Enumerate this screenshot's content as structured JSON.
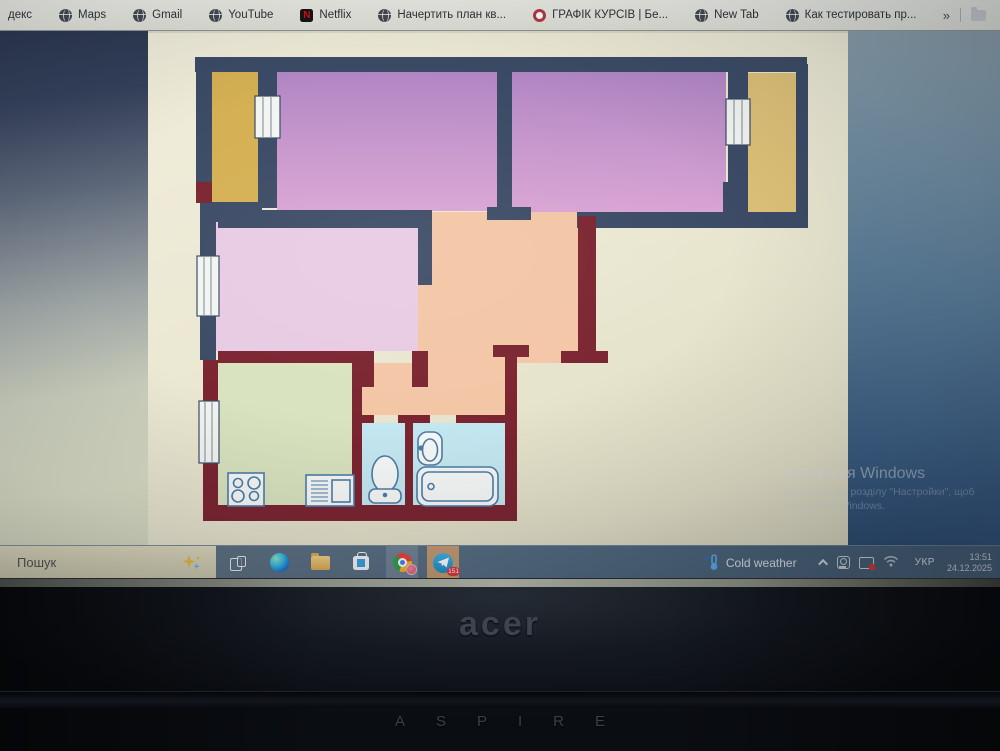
{
  "bookmarks_bar": {
    "items": [
      {
        "label": "декс",
        "icon": "none"
      },
      {
        "label": "Maps",
        "icon": "globe"
      },
      {
        "label": "Gmail",
        "icon": "globe"
      },
      {
        "label": "YouTube",
        "icon": "globe"
      },
      {
        "label": "Netflix",
        "icon": "netflix"
      },
      {
        "label": "Начертить план кв...",
        "icon": "globe"
      },
      {
        "label": "ГРАФІК КУРСІВ | Бе...",
        "icon": "target"
      },
      {
        "label": "New Tab",
        "icon": "globe"
      },
      {
        "label": "Как тестировать пр...",
        "icon": "globe"
      },
      {
        "label": "Mystat",
        "icon": "globe"
      }
    ],
    "overflow": "»"
  },
  "floorplan": {
    "description": "apartment floor plan drawing on white canvas",
    "colors": {
      "wall_navy": "#3c4b66",
      "wall_maroon": "#7b2531",
      "room_purple": "#b186c5",
      "room_purple_light": "#d9a4d3",
      "balcony_yellow": "#d5b054",
      "balcony_yellow_right": "#ddc177",
      "room_pink": "#e8cbe4",
      "corridor_peach": "#f3c6a6",
      "kitchen_green": "#d9e3bf",
      "bath_blue": "#c4e8f1",
      "window_fill": "#f3f5f1",
      "fixture_stroke": "#4d7da6",
      "fixture_fill": "#f6f9f7",
      "telegram_tile": "#c59a6f"
    }
  },
  "watermark": {
    "title": "Активація Windows",
    "line1": "Перейдіть до розділу \"Настройки\", щоб",
    "line2": "активувати Windows."
  },
  "taskbar": {
    "search_placeholder": "Пошук",
    "pinned_icons": [
      "task-view",
      "edge",
      "file-explorer",
      "microsoft-store",
      "chrome",
      "telegram"
    ],
    "telegram_badge": "151",
    "weather_label": "Cold weather",
    "tray_icons": [
      "hidden-icons-chevron",
      "app-tray-icon",
      "display-capture-icon",
      "wifi"
    ],
    "language": "УКР",
    "time": "13:51",
    "date": "24.12.2025"
  },
  "bezel": {
    "brand": "acer",
    "model": "ASPIRE"
  }
}
